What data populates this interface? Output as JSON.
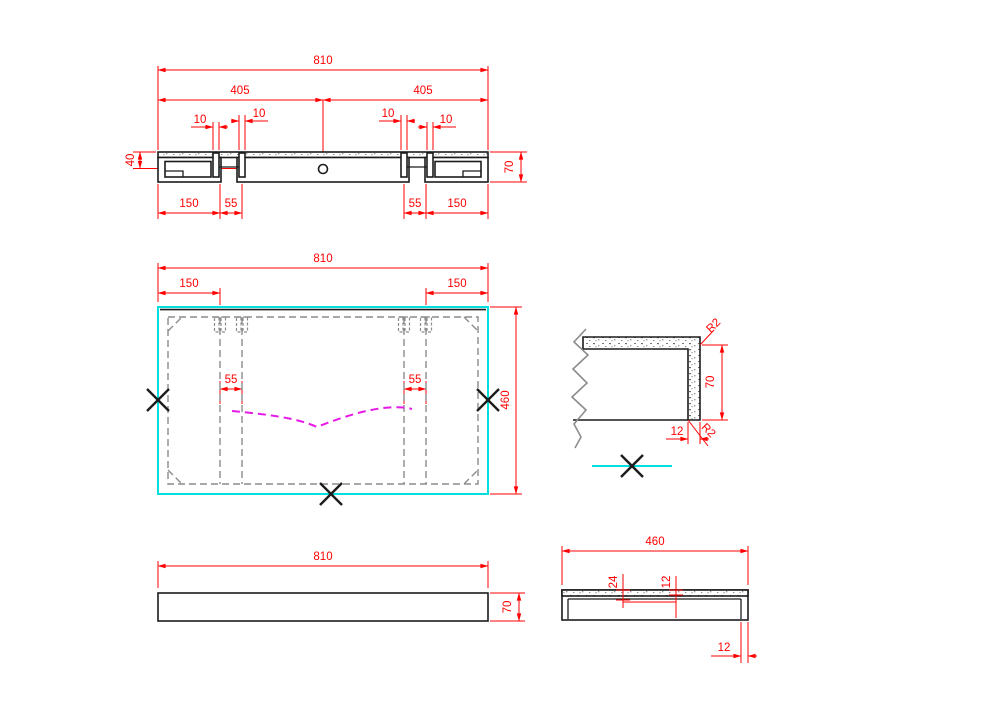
{
  "palette": {
    "dimension_color": "#ff0000",
    "outline_color": "#1c1c1c",
    "hidden_line_color": "#8c8c8c",
    "accent_cyan": "#00dede",
    "accent_magenta": "#e619e6"
  },
  "views": {
    "section": {
      "dims": {
        "overall": "810",
        "half_left": "405",
        "half_right": "405",
        "slot_a": "10",
        "slot_b": "10",
        "slot_c": "10",
        "slot_d": "10",
        "hole_offset": "40",
        "thickness": "70",
        "end_left": "150",
        "gap_left": "55",
        "gap_right": "55",
        "end_right": "150"
      }
    },
    "plan": {
      "dims": {
        "overall": "810",
        "margin_left": "150",
        "margin_right": "150",
        "gap_left": "55",
        "gap_right": "55",
        "depth": "460"
      }
    },
    "detail": {
      "dims": {
        "radius_top": "R2",
        "radius_bottom": "R2",
        "thickness": "70",
        "edge": "12"
      }
    },
    "front": {
      "dims": {
        "overall": "810",
        "thickness": "70"
      }
    },
    "side": {
      "dims": {
        "depth": "460",
        "rebate": "24",
        "laminate": "12",
        "edge": "12"
      }
    }
  }
}
